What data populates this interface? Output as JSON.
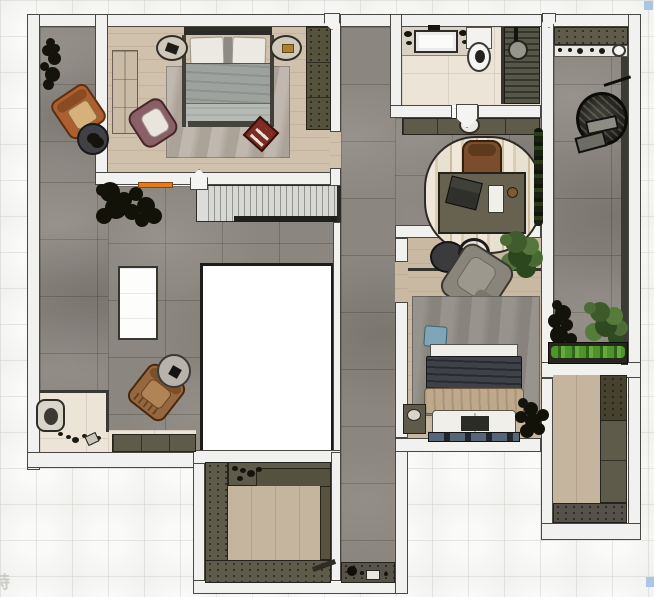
{
  "watermark": {
    "text": "特"
  },
  "plan": {
    "type": "residential-floor-plan-render",
    "rooms": [
      {
        "id": "master-bedroom",
        "label": "Master bedroom",
        "floor": "wood-plank"
      },
      {
        "id": "bathroom",
        "label": "Bathroom",
        "floor": "marble-tile"
      },
      {
        "id": "hallway-office",
        "label": "Hallway and desk nook",
        "floor": "stone-tile"
      },
      {
        "id": "living-terrace",
        "label": "Living area / terrace",
        "floor": "stone-tile"
      },
      {
        "id": "second-bedroom",
        "label": "Second bedroom",
        "floor": "wood-plank"
      },
      {
        "id": "balcony",
        "label": "Balcony",
        "floor": "stone-tile"
      },
      {
        "id": "walk-in-closet",
        "label": "Walk-in closet",
        "floor": "wood-plank"
      },
      {
        "id": "storage-room",
        "label": "Storage room",
        "floor": "wood-plank"
      },
      {
        "id": "entry",
        "label": "Entry",
        "floor": "marble"
      },
      {
        "id": "staircase",
        "label": "Staircase",
        "floor": "treads"
      },
      {
        "id": "void",
        "label": "Open to below",
        "floor": "none"
      }
    ],
    "furniture": [
      {
        "room": "master-bedroom",
        "items": [
          "double-bed",
          "pillows",
          "area-rug",
          "wardrobe",
          "tall-cabinet",
          "oval-nightstand-left",
          "oval-nightstand-right",
          "plum-armchair",
          "red-tray"
        ]
      },
      {
        "room": "living-terrace",
        "items": [
          "orange-armchair",
          "round-side-table",
          "potted-plant",
          "tree-plant",
          "kitchen-island",
          "brown-armchair",
          "round-coffee-table",
          "doormat",
          "shoes",
          "shoe-cabinet",
          "orange-mat"
        ]
      },
      {
        "room": "bathroom",
        "items": [
          "vanity-sink",
          "toilet",
          "shower",
          "glass-partition"
        ]
      },
      {
        "room": "hallway-office",
        "items": [
          "console-cabinet",
          "vase",
          "oval-rug",
          "desk",
          "desk-chair",
          "laptop",
          "notepad",
          "bowl",
          "plant-hedge",
          "service-counter",
          "kettle"
        ]
      },
      {
        "room": "second-bedroom",
        "items": [
          "double-bed",
          "blue-pillow",
          "area-rug",
          "gray-armchair",
          "round-side-tables",
          "potted-plant",
          "nightstand",
          "dry-plant",
          "bench"
        ]
      },
      {
        "room": "balcony",
        "items": [
          "hanging-egg-chair",
          "shelf-with-bottles",
          "potted-plants",
          "planter-box"
        ]
      },
      {
        "room": "walk-in-closet",
        "items": [
          "wardrobe-units",
          "shelf-items",
          "ladder"
        ]
      },
      {
        "room": "storage-room",
        "items": [
          "cabinet-column",
          "low-units"
        ]
      }
    ]
  },
  "palette": {
    "wall": "#f1f1ef",
    "stone_tile": "#8b867f",
    "wood": "#cdbea8",
    "olive_cabinet": "#5f5b4a",
    "marble": "#ece4d6",
    "accent_orange": "#e07b20",
    "planter_green": "#4f942b",
    "handle_blue": "#aac6e4",
    "void_white": "#ffffff"
  },
  "handles": {
    "count": 2,
    "color": "#aac6e4"
  }
}
